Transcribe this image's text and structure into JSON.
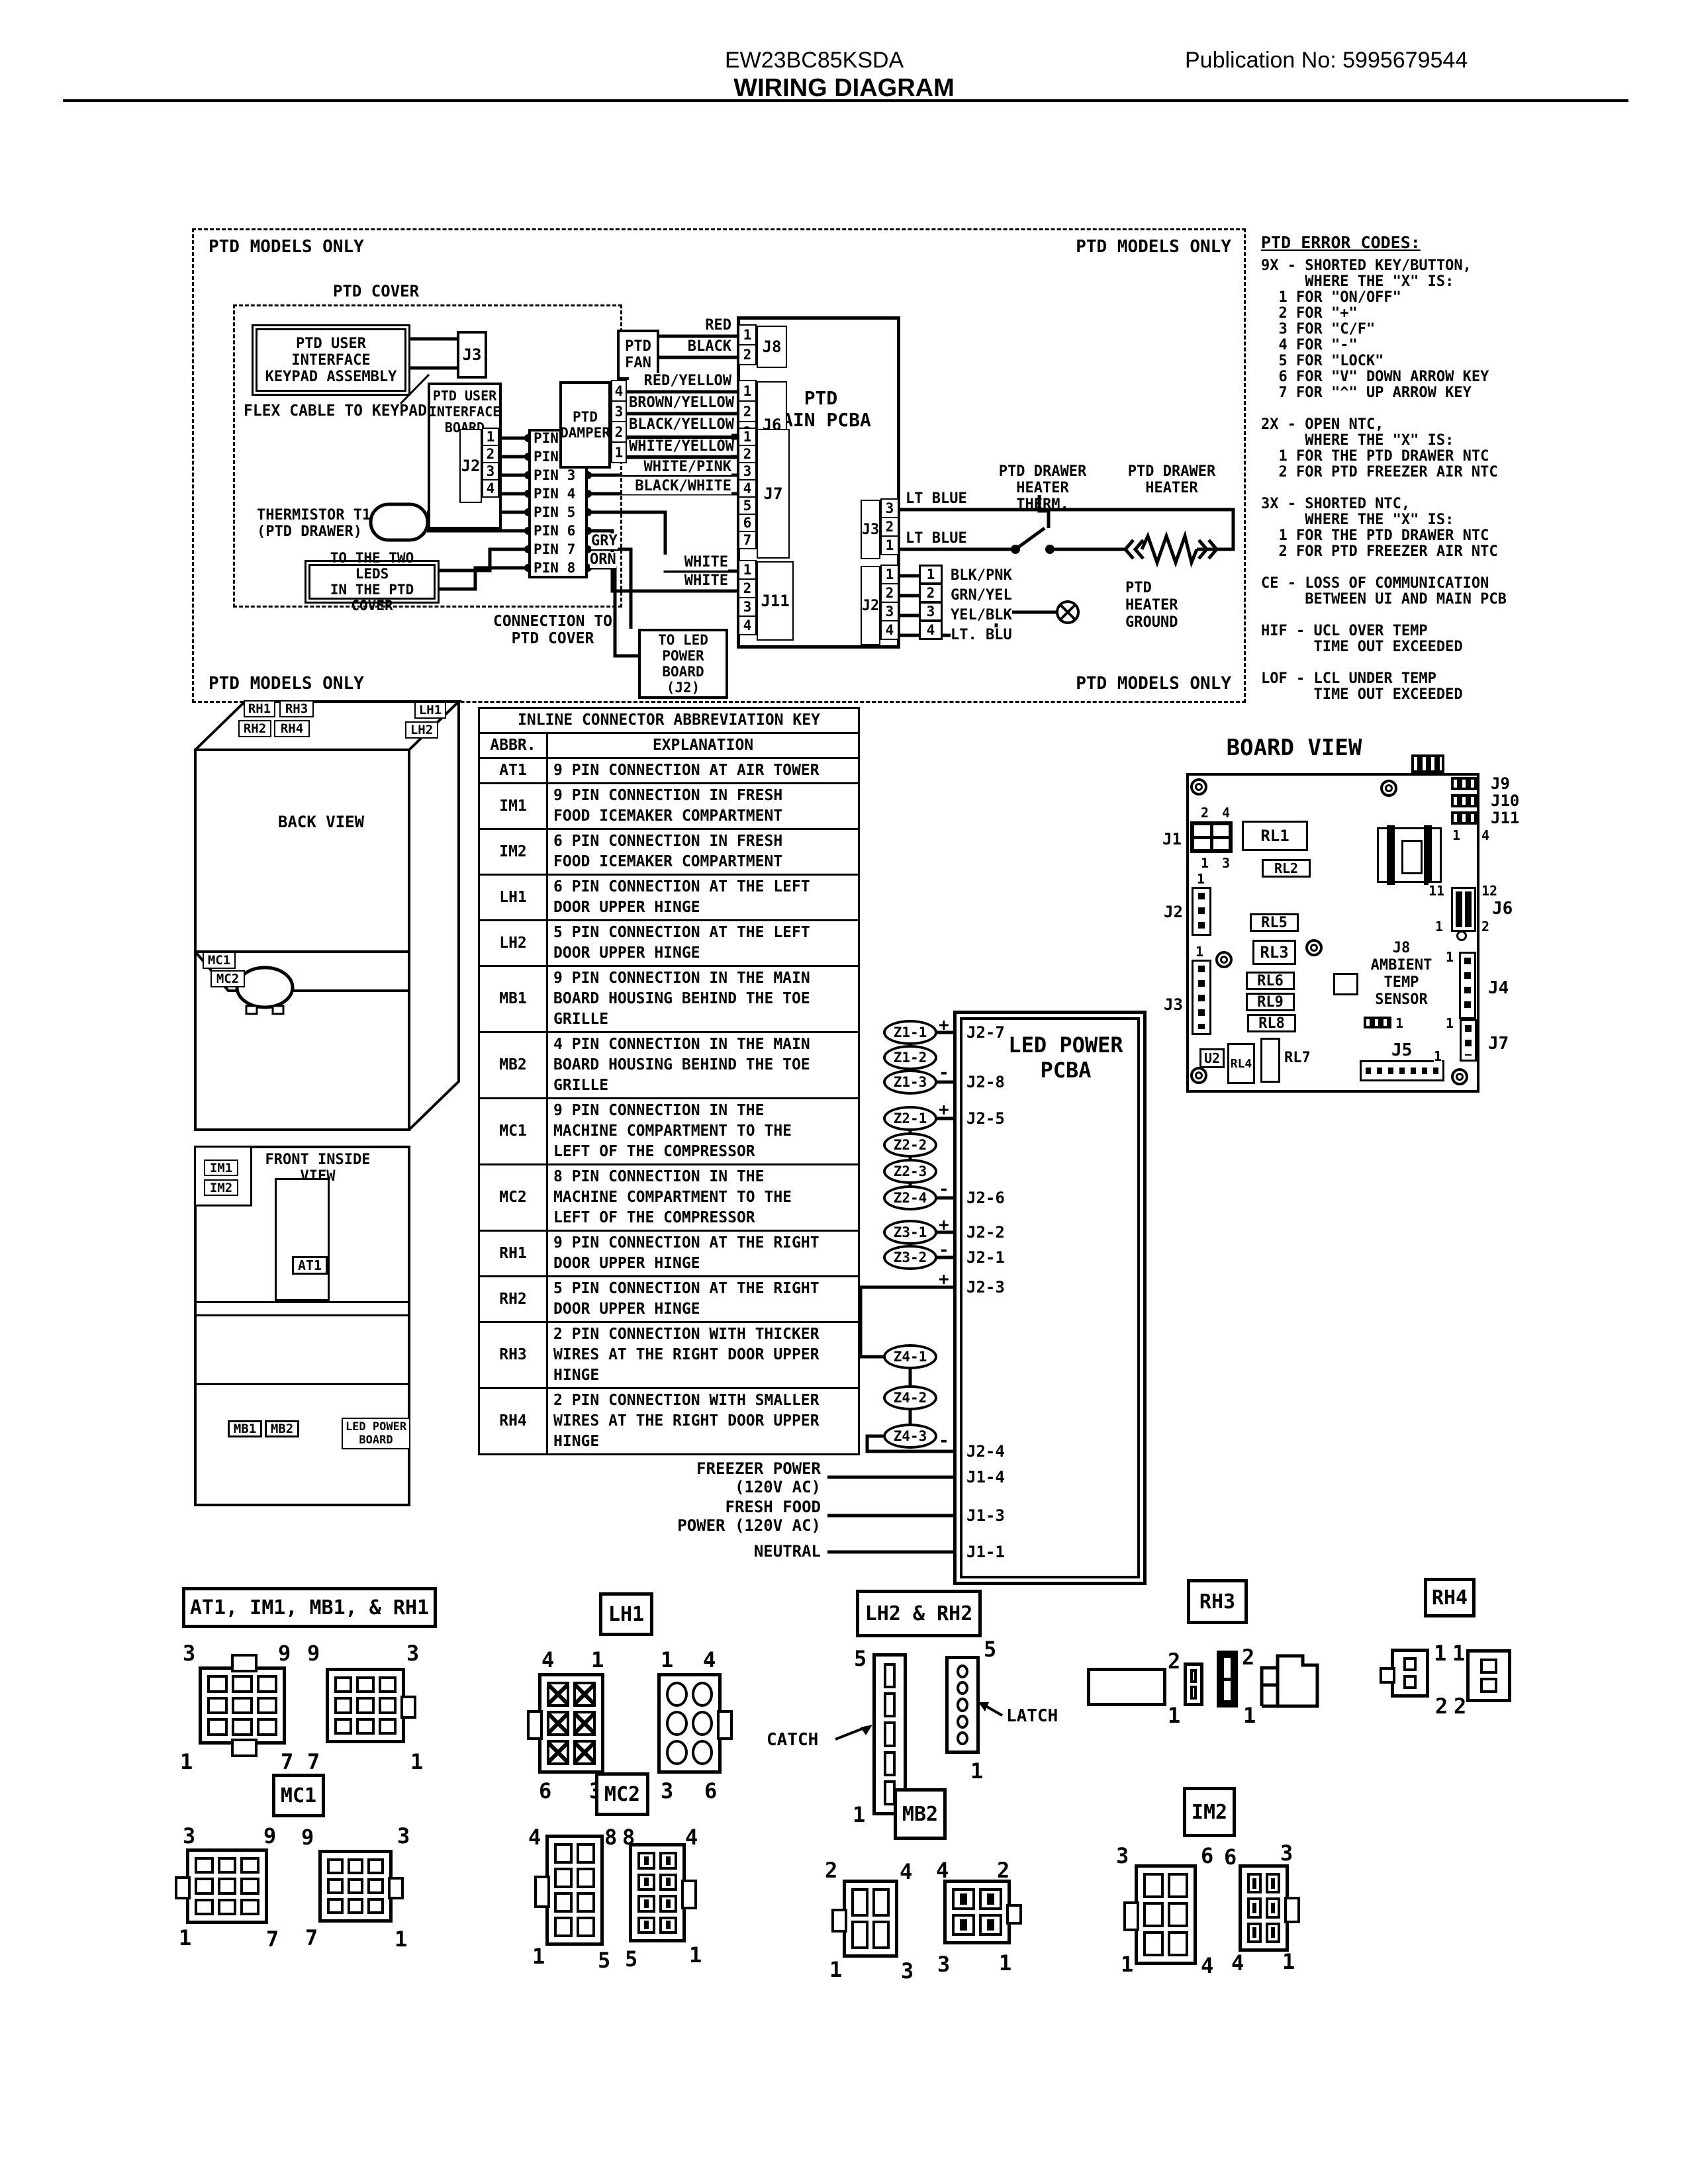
{
  "header": {
    "model": "EW23BC85KSDA",
    "publication": "Publication No:  5995679544",
    "title": "WIRING DIAGRAM"
  },
  "ptd": {
    "models_only": "PTD MODELS ONLY",
    "cover": "PTD COVER",
    "keypad": "PTD USER INTERFACE\nKEYPAD ASSEMBLY",
    "flex": "FLEX CABLE TO KEYPAD",
    "j3": "J3",
    "board": "PTD USER\nINTERFACE\nBOARD",
    "j2": "J2",
    "j2_pins": [
      "1",
      "2",
      "3",
      "4"
    ],
    "pins": [
      "PIN 1",
      "PIN 2",
      "PIN 3",
      "PIN 4",
      "PIN 5",
      "PIN 6",
      "PIN 7",
      "PIN 8"
    ],
    "pin_wires": [
      "RED/BLACK",
      "PINK/WHITE",
      "WHITE/PINK",
      "BLACK/WHITE"
    ],
    "gry": "GRY",
    "orn": "ORN",
    "white_1": "WHITE",
    "white_2": "WHITE",
    "thermistor": "THERMISTOR T1\n(PTD DRAWER)",
    "leds": "TO THE TWO LEDS\nIN THE PTD COVER",
    "connection": "CONNECTION TO\nPTD COVER",
    "to_led": "TO LED\nPOWER BOARD\n(J2)",
    "fan": "PTD\nFAN",
    "fan_wires": [
      "RED",
      "BLACK"
    ],
    "damper": "PTD\nDAMPER",
    "damper_pins": [
      "4",
      "3",
      "2",
      "1"
    ],
    "damper_wires": [
      "RED/YELLOW",
      "BROWN/YELLOW",
      "BLACK/YELLOW",
      "WHITE/YELLOW"
    ],
    "pcba": "PTD\nMAIN PCBA",
    "j8": "J8",
    "j8_pins": [
      "1",
      "2"
    ],
    "j6": "J6",
    "j6_pins": [
      "1",
      "2",
      "3",
      "4"
    ],
    "j7": "J7",
    "j7_pins": [
      "1",
      "2",
      "3",
      "4",
      "5",
      "6",
      "7"
    ],
    "j11": "J11",
    "j11_pins": [
      "1",
      "2",
      "3",
      "4"
    ],
    "lt_blue_1": "LT BLUE",
    "lt_blue_2": "LT BLUE",
    "therm_label": "PTD DRAWER\nHEATER THERM.",
    "heater_label": "PTD DRAWER\nHEATER",
    "ground_label": "PTD\nHEATER\nGROUND",
    "j3r": "J3",
    "j3r_pins": [
      "3",
      "2",
      "1"
    ],
    "j2r": "J2",
    "j2r_pins": [
      "1",
      "2",
      "3",
      "4"
    ],
    "j2r_block_pins": [
      "1",
      "2",
      "3",
      "4"
    ],
    "j2r_wires": [
      "BLK/PNK",
      "GRN/YEL",
      "YEL/BLK",
      "LT. BLU"
    ]
  },
  "error_codes": {
    "heading": "PTD ERROR CODES:",
    "body": "9X - SHORTED KEY/BUTTON,\n     WHERE THE \"X\" IS:\n  1 FOR \"ON/OFF\"\n  2 FOR \"+\"\n  3 FOR \"C/F\"\n  4 FOR \"-\"\n  5 FOR \"LOCK\"\n  6 FOR \"V\" DOWN ARROW KEY\n  7 FOR \"^\" UP ARROW KEY\n\n2X - OPEN NTC,\n     WHERE THE \"X\" IS:\n  1 FOR THE PTD DRAWER NTC\n  2 FOR PTD FREEZER AIR NTC\n\n3X - SHORTED NTC,\n     WHERE THE \"X\" IS:\n  1 FOR THE PTD DRAWER NTC\n  2 FOR PTD FREEZER AIR NTC\n\nCE - LOSS OF COMMUNICATION\n     BETWEEN UI AND MAIN PCB\n\nHIF - UCL OVER TEMP\n      TIME OUT EXCEEDED\n\nLOF - LCL UNDER TEMP\n      TIME OUT EXCEEDED"
  },
  "back_view": {
    "title": "BACK VIEW",
    "rh1": "RH1",
    "rh3": "RH3",
    "rh2": "RH2",
    "rh4": "RH4",
    "lh1": "LH1",
    "lh2": "LH2",
    "mc1": "MC1",
    "mc2": "MC2"
  },
  "front_view": {
    "title": "FRONT INSIDE\nVIEW",
    "im1": "IM1",
    "im2": "IM2",
    "at1": "AT1",
    "mb1": "MB1",
    "mb2": "MB2",
    "led_board": "LED POWER\nBOARD"
  },
  "table": {
    "title": "INLINE CONNECTOR ABBREVIATION KEY",
    "col_abbr": "ABBR.",
    "col_expl": "EXPLANATION",
    "rows": [
      {
        "abbr": "AT1",
        "text": "9 PIN CONNECTION AT AIR TOWER"
      },
      {
        "abbr": "IM1",
        "text": "9 PIN CONNECTION IN FRESH\nFOOD ICEMAKER COMPARTMENT"
      },
      {
        "abbr": "IM2",
        "text": "6 PIN CONNECTION IN FRESH\nFOOD ICEMAKER COMPARTMENT"
      },
      {
        "abbr": "LH1",
        "text": "6 PIN CONNECTION AT THE LEFT\nDOOR UPPER HINGE"
      },
      {
        "abbr": "LH2",
        "text": "5 PIN CONNECTION AT THE LEFT\nDOOR UPPER HINGE"
      },
      {
        "abbr": "MB1",
        "text": "9 PIN CONNECTION IN THE MAIN\nBOARD HOUSING BEHIND THE TOE\nGRILLE"
      },
      {
        "abbr": "MB2",
        "text": "4 PIN CONNECTION IN THE MAIN\nBOARD HOUSING BEHIND THE TOE\nGRILLE"
      },
      {
        "abbr": "MC1",
        "text": "9 PIN CONNECTION IN THE\nMACHINE COMPARTMENT TO THE\nLEFT OF THE COMPRESSOR"
      },
      {
        "abbr": "MC2",
        "text": "8 PIN CONNECTION IN THE\nMACHINE COMPARTMENT TO THE\nLEFT OF THE COMPRESSOR"
      },
      {
        "abbr": "RH1",
        "text": "9 PIN CONNECTION AT THE RIGHT\nDOOR UPPER HINGE"
      },
      {
        "abbr": "RH2",
        "text": "5 PIN CONNECTION AT THE RIGHT\nDOOR UPPER HINGE"
      },
      {
        "abbr": "RH3",
        "text": "2 PIN CONNECTION WITH THICKER\nWIRES AT THE RIGHT DOOR UPPER\nHINGE"
      },
      {
        "abbr": "RH4",
        "text": "2 PIN CONNECTION WITH SMALLER\nWIRES AT THE RIGHT DOOR UPPER\nHINGE"
      }
    ]
  },
  "led": {
    "title": "LED POWER\nPCBA",
    "z11": "Z1-1",
    "z12": "Z1-2",
    "z13": "Z1-3",
    "z21": "Z2-1",
    "z22": "Z2-2",
    "z23": "Z2-3",
    "z24": "Z2-4",
    "z31": "Z3-1",
    "z32": "Z3-2",
    "z41": "Z4-1",
    "z42": "Z4-2",
    "z43": "Z4-3",
    "ports": {
      "j2_7": "J2-7",
      "j2_8": "J2-8",
      "j2_5": "J2-5",
      "j2_6": "J2-6",
      "j2_2": "J2-2",
      "j2_1": "J2-1",
      "j2_3": "J2-3",
      "j2_4": "J2-4",
      "j1_4": "J1-4",
      "j1_3": "J1-3",
      "j1_1": "J1-1"
    },
    "plus": "+",
    "minus": "-",
    "freezer": "FREEZER POWER\n(120V AC)",
    "fresh": "FRESH FOOD\nPOWER (120V AC)",
    "neutral": "NEUTRAL"
  },
  "board": {
    "title": "BOARD VIEW",
    "j1": "J1",
    "j1_t1": "2",
    "j1_t2": "4",
    "j1_b1": "1",
    "j1_b2": "3",
    "rl1": "RL1",
    "rl2": "RL2",
    "rl3": "RL3",
    "rl4": "RL4",
    "rl5": "RL5",
    "rl6": "RL6",
    "rl7": "RL7",
    "rl8": "RL8",
    "rl9": "RL9",
    "u2": "U2",
    "j2": "J2",
    "j2_pin": "1",
    "j3": "J3",
    "j3_pin": "1",
    "j9": "J9",
    "j10": "J10",
    "j11": "J11",
    "j11_p1": "1",
    "j11_p4": "4",
    "j6": "J6",
    "j6_11": "11",
    "j6_12": "12",
    "j6_1": "1",
    "j6_2": "2",
    "j8_sensor": "J8\nAMBIENT\nTEMP\nSENSOR",
    "j4": "J4",
    "j4_pin": "1",
    "j7": "J7",
    "j7_pin": "1",
    "j5": "J5",
    "j5_pin": "1",
    "p3_pin": "1"
  },
  "figures": {
    "f1": {
      "label": "AT1, IM1, MB1, & RH1",
      "a": {
        "tl": "3",
        "tr": "9",
        "bl": "1",
        "br": "7"
      },
      "b": {
        "tl": "9",
        "tr": "3",
        "bl": "7",
        "br": "1"
      }
    },
    "lh1": {
      "label": "LH1",
      "a": {
        "tl": "4",
        "tr": "1",
        "bl": "6",
        "br": "3"
      },
      "b": {
        "tl": "1",
        "tr": "4",
        "bl": "3",
        "br": "6"
      }
    },
    "lh2rh2": {
      "label": "LH2 & RH2",
      "catch": "CATCH",
      "latch": "LATCH",
      "a": {
        "top": "5",
        "bottom": "1"
      },
      "b": {
        "top": "5",
        "bottom": "1"
      }
    },
    "rh3": {
      "label": "RH3",
      "a": {
        "top": "2",
        "bottom": "1"
      },
      "b": {
        "top": "2",
        "bottom": "1"
      }
    },
    "rh4": {
      "label": "RH4",
      "a": {
        "top": "1",
        "bottom": "2"
      },
      "b": {
        "top": "1",
        "bottom": "2"
      }
    },
    "mc1": {
      "label": "MC1",
      "a": {
        "tl": "3",
        "tr": "9",
        "bl": "1",
        "br": "7"
      },
      "b": {
        "tl": "9",
        "tr": "3",
        "bl": "7",
        "br": "1"
      }
    },
    "mc2": {
      "label": "MC2",
      "a": {
        "tl": "4",
        "tr": "8",
        "bl": "1",
        "br": "5"
      },
      "b": {
        "tl": "8",
        "tr": "4",
        "bl": "5",
        "br": "1"
      }
    },
    "mb2": {
      "label": "MB2",
      "a": {
        "tl": "2",
        "tr": "4",
        "bl": "1",
        "br": "3"
      },
      "b": {
        "tl": "4",
        "tr": "2",
        "bl": "3",
        "br": "1"
      }
    },
    "im2": {
      "label": "IM2",
      "a": {
        "tl": "3",
        "tr": "6",
        "bl": "1",
        "br": "4"
      },
      "b": {
        "tl": "6",
        "tr": "3",
        "bl": "4",
        "br": "1"
      }
    }
  }
}
